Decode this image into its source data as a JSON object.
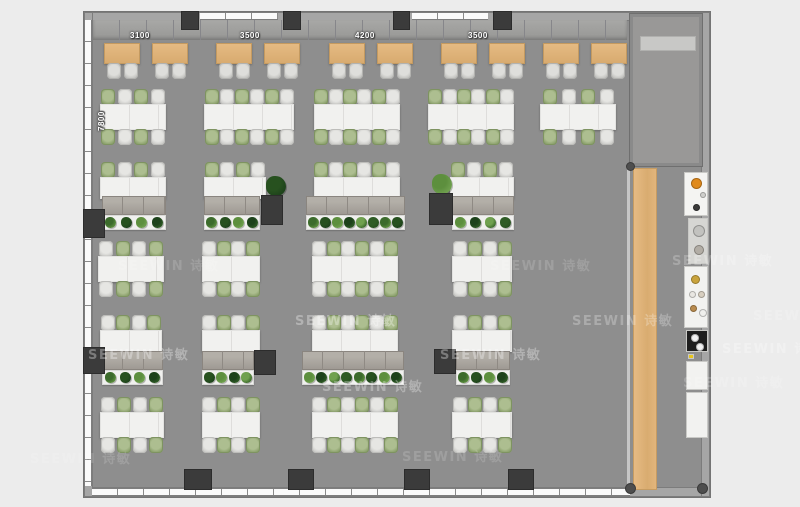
{
  "watermark": {
    "text": "SEEWIN 诗敏"
  },
  "dimension_labels": {
    "top": [
      {
        "text": "3100",
        "x": 130,
        "y": 31
      },
      {
        "text": "3500",
        "x": 240,
        "y": 31
      },
      {
        "text": "4200",
        "x": 355,
        "y": 31
      },
      {
        "text": "3500",
        "x": 468,
        "y": 31
      }
    ],
    "left": {
      "text": "7800",
      "x": 97,
      "y": 131
    }
  },
  "colors": {
    "background": "#ececec",
    "floor": "#8e8e8e",
    "wall": "#a6a6a6",
    "pillar": "#3b3b3b",
    "wood": "#dcb077",
    "desk_white": "#f1f1ef",
    "table_tan": "#ddb279",
    "chair_green": "#92a873",
    "chair_gray": "#d3d3d0",
    "plant_green": "#3c6b2c",
    "appliance_orange": "#e08a1c",
    "appliance_black": "#1e1e1e"
  },
  "plan": {
    "tan_tables": [
      {
        "x": 104,
        "y": 43
      },
      {
        "x": 152,
        "y": 43
      },
      {
        "x": 216,
        "y": 43
      },
      {
        "x": 264,
        "y": 43
      },
      {
        "x": 329,
        "y": 43
      },
      {
        "x": 377,
        "y": 43
      },
      {
        "x": 441,
        "y": 43
      },
      {
        "x": 489,
        "y": 43
      },
      {
        "x": 543,
        "y": 43
      },
      {
        "x": 591,
        "y": 43
      }
    ],
    "double_desks": [
      {
        "x": 100,
        "y": 104,
        "w": 66,
        "seats": 4,
        "start": "green"
      },
      {
        "x": 204,
        "y": 104,
        "w": 90,
        "seats": 6,
        "start": "green"
      },
      {
        "x": 314,
        "y": 104,
        "w": 86,
        "seats": 6,
        "start": "green"
      },
      {
        "x": 428,
        "y": 104,
        "w": 86,
        "seats": 6,
        "start": "green"
      },
      {
        "x": 540,
        "y": 104,
        "w": 76,
        "seats": 4,
        "start": "green"
      },
      {
        "x": 98,
        "y": 256,
        "w": 66,
        "seats": 4,
        "start": "gray"
      },
      {
        "x": 202,
        "y": 256,
        "w": 58,
        "seats": 4,
        "start": "gray"
      },
      {
        "x": 312,
        "y": 256,
        "w": 86,
        "seats": 6,
        "start": "gray"
      },
      {
        "x": 452,
        "y": 256,
        "w": 60,
        "seats": 4,
        "start": "gray"
      },
      {
        "x": 100,
        "y": 412,
        "w": 64,
        "seats": 4,
        "start": "gray"
      },
      {
        "x": 202,
        "y": 412,
        "w": 58,
        "seats": 4,
        "start": "gray"
      },
      {
        "x": 312,
        "y": 412,
        "w": 86,
        "seats": 6,
        "start": "gray"
      },
      {
        "x": 452,
        "y": 412,
        "w": 60,
        "seats": 4,
        "start": "gray"
      }
    ],
    "single_desks": [
      {
        "x": 100,
        "y": 177,
        "w": 66,
        "seats": 4,
        "start": "green"
      },
      {
        "x": 204,
        "y": 177,
        "w": 62,
        "seats": 4,
        "start": "green"
      },
      {
        "x": 314,
        "y": 177,
        "w": 86,
        "seats": 6,
        "start": "green"
      },
      {
        "x": 450,
        "y": 177,
        "w": 64,
        "seats": 4,
        "start": "green"
      },
      {
        "x": 100,
        "y": 330,
        "w": 62,
        "seats": 4,
        "start": "gray"
      },
      {
        "x": 202,
        "y": 330,
        "w": 58,
        "seats": 4,
        "start": "gray"
      },
      {
        "x": 312,
        "y": 330,
        "w": 86,
        "seats": 6,
        "start": "gray"
      },
      {
        "x": 452,
        "y": 330,
        "w": 60,
        "seats": 4,
        "start": "gray"
      }
    ],
    "lockers": [
      {
        "x": 102,
        "y": 196,
        "w": 64
      },
      {
        "x": 204,
        "y": 196,
        "w": 56
      },
      {
        "x": 306,
        "y": 196,
        "w": 99
      },
      {
        "x": 452,
        "y": 196,
        "w": 62
      },
      {
        "x": 102,
        "y": 351,
        "w": 61
      },
      {
        "x": 202,
        "y": 351,
        "w": 52
      },
      {
        "x": 302,
        "y": 351,
        "w": 102
      },
      {
        "x": 456,
        "y": 351,
        "w": 54
      }
    ],
    "planters": [
      {
        "x": 102,
        "y": 215,
        "w": 64,
        "n": 4
      },
      {
        "x": 204,
        "y": 215,
        "w": 56,
        "n": 4
      },
      {
        "x": 306,
        "y": 215,
        "w": 99,
        "n": 8
      },
      {
        "x": 452,
        "y": 215,
        "w": 62,
        "n": 4
      },
      {
        "x": 102,
        "y": 370,
        "w": 61,
        "n": 4
      },
      {
        "x": 202,
        "y": 370,
        "w": 52,
        "n": 4
      },
      {
        "x": 302,
        "y": 370,
        "w": 102,
        "n": 8
      },
      {
        "x": 456,
        "y": 370,
        "w": 54,
        "n": 4
      }
    ],
    "pillars": [
      {
        "x": 182,
        "y": 12,
        "w": 16,
        "h": 17
      },
      {
        "x": 284,
        "y": 12,
        "w": 16,
        "h": 17
      },
      {
        "x": 394,
        "y": 12,
        "w": 15,
        "h": 17
      },
      {
        "x": 494,
        "y": 12,
        "w": 17,
        "h": 17
      },
      {
        "x": 185,
        "y": 470,
        "w": 26,
        "h": 19
      },
      {
        "x": 289,
        "y": 470,
        "w": 24,
        "h": 19
      },
      {
        "x": 405,
        "y": 470,
        "w": 24,
        "h": 19
      },
      {
        "x": 509,
        "y": 470,
        "w": 24,
        "h": 19
      },
      {
        "x": 84,
        "y": 210,
        "w": 20,
        "h": 27
      },
      {
        "x": 84,
        "y": 348,
        "w": 20,
        "h": 25
      },
      {
        "x": 262,
        "y": 196,
        "w": 20,
        "h": 28
      },
      {
        "x": 430,
        "y": 194,
        "w": 22,
        "h": 30
      },
      {
        "x": 255,
        "y": 351,
        "w": 20,
        "h": 23
      },
      {
        "x": 435,
        "y": 350,
        "w": 20,
        "h": 23
      }
    ],
    "standalone_plants": [
      {
        "x": 266,
        "y": 176,
        "s": 20
      },
      {
        "x": 432,
        "y": 174,
        "s": 20
      }
    ],
    "counters": [
      {
        "x": 684,
        "y": 172,
        "w": 24,
        "h": 44,
        "bg": "#f4f4f2",
        "circles": [
          {
            "x": 6,
            "y": 5,
            "d": 11,
            "c": "#e08a1c"
          },
          {
            "x": 15,
            "y": 19,
            "d": 6,
            "c": "#cfcfcc"
          },
          {
            "x": 8,
            "y": 31,
            "d": 7,
            "c": "#3a3a3a"
          }
        ]
      },
      {
        "x": 688,
        "y": 218,
        "w": 20,
        "h": 46,
        "bg": "#d6d6d3",
        "circles": [
          {
            "x": 4,
            "y": 6,
            "d": 12,
            "c": "#c2c2bf"
          },
          {
            "x": 5,
            "y": 26,
            "d": 10,
            "c": "#b2ada5"
          }
        ]
      },
      {
        "x": 684,
        "y": 266,
        "w": 24,
        "h": 62,
        "bg": "#f2f2f0",
        "circles": [
          {
            "x": 6,
            "y": 8,
            "d": 9,
            "c": "#c9a33c"
          },
          {
            "x": 4,
            "y": 24,
            "d": 7,
            "c": "#e9e7e2"
          },
          {
            "x": 13,
            "y": 24,
            "d": 7,
            "c": "#d8cfc0"
          },
          {
            "x": 5,
            "y": 38,
            "d": 7,
            "c": "#b98b4e"
          },
          {
            "x": 14,
            "y": 42,
            "d": 8,
            "c": "#efefec"
          }
        ]
      },
      {
        "x": 686,
        "y": 330,
        "w": 22,
        "h": 22,
        "bg": "#1e1e1e",
        "circles": [
          {
            "x": 4,
            "y": 3,
            "d": 8,
            "c": "#f2f2f2"
          },
          {
            "x": 9,
            "y": 12,
            "d": 8,
            "c": "#f2f2f2"
          }
        ]
      },
      {
        "x": 688,
        "y": 354,
        "w": 6,
        "h": 5,
        "bg": "#e6c51e",
        "circles": []
      },
      {
        "x": 686,
        "y": 361,
        "w": 22,
        "h": 29,
        "bg": "#f2f2f0",
        "circles": []
      },
      {
        "x": 686,
        "y": 392,
        "w": 22,
        "h": 46,
        "bg": "#f2f2f0",
        "circles": []
      }
    ],
    "watermarks": [
      {
        "x": 118,
        "y": 255,
        "o": 0.15
      },
      {
        "x": 490,
        "y": 255,
        "o": 0.15
      },
      {
        "x": 672,
        "y": 250,
        "o": 0.22
      },
      {
        "x": 295,
        "y": 310,
        "o": 0.32
      },
      {
        "x": 572,
        "y": 310,
        "o": 0.26
      },
      {
        "x": 753,
        "y": 305,
        "o": 0.2
      },
      {
        "x": 88,
        "y": 344,
        "o": 0.32
      },
      {
        "x": 440,
        "y": 344,
        "o": 0.32
      },
      {
        "x": 722,
        "y": 338,
        "o": 0.28
      },
      {
        "x": 322,
        "y": 376,
        "o": 0.3
      },
      {
        "x": 683,
        "y": 372,
        "o": 0.18
      },
      {
        "x": 30,
        "y": 448,
        "o": 0.15
      },
      {
        "x": 402,
        "y": 446,
        "o": 0.15
      }
    ],
    "plant_colors": [
      "#3c6b2c",
      "#27511f",
      "#5d8f3e",
      "#1d421b",
      "#70a14f",
      "#2f5c25"
    ]
  }
}
